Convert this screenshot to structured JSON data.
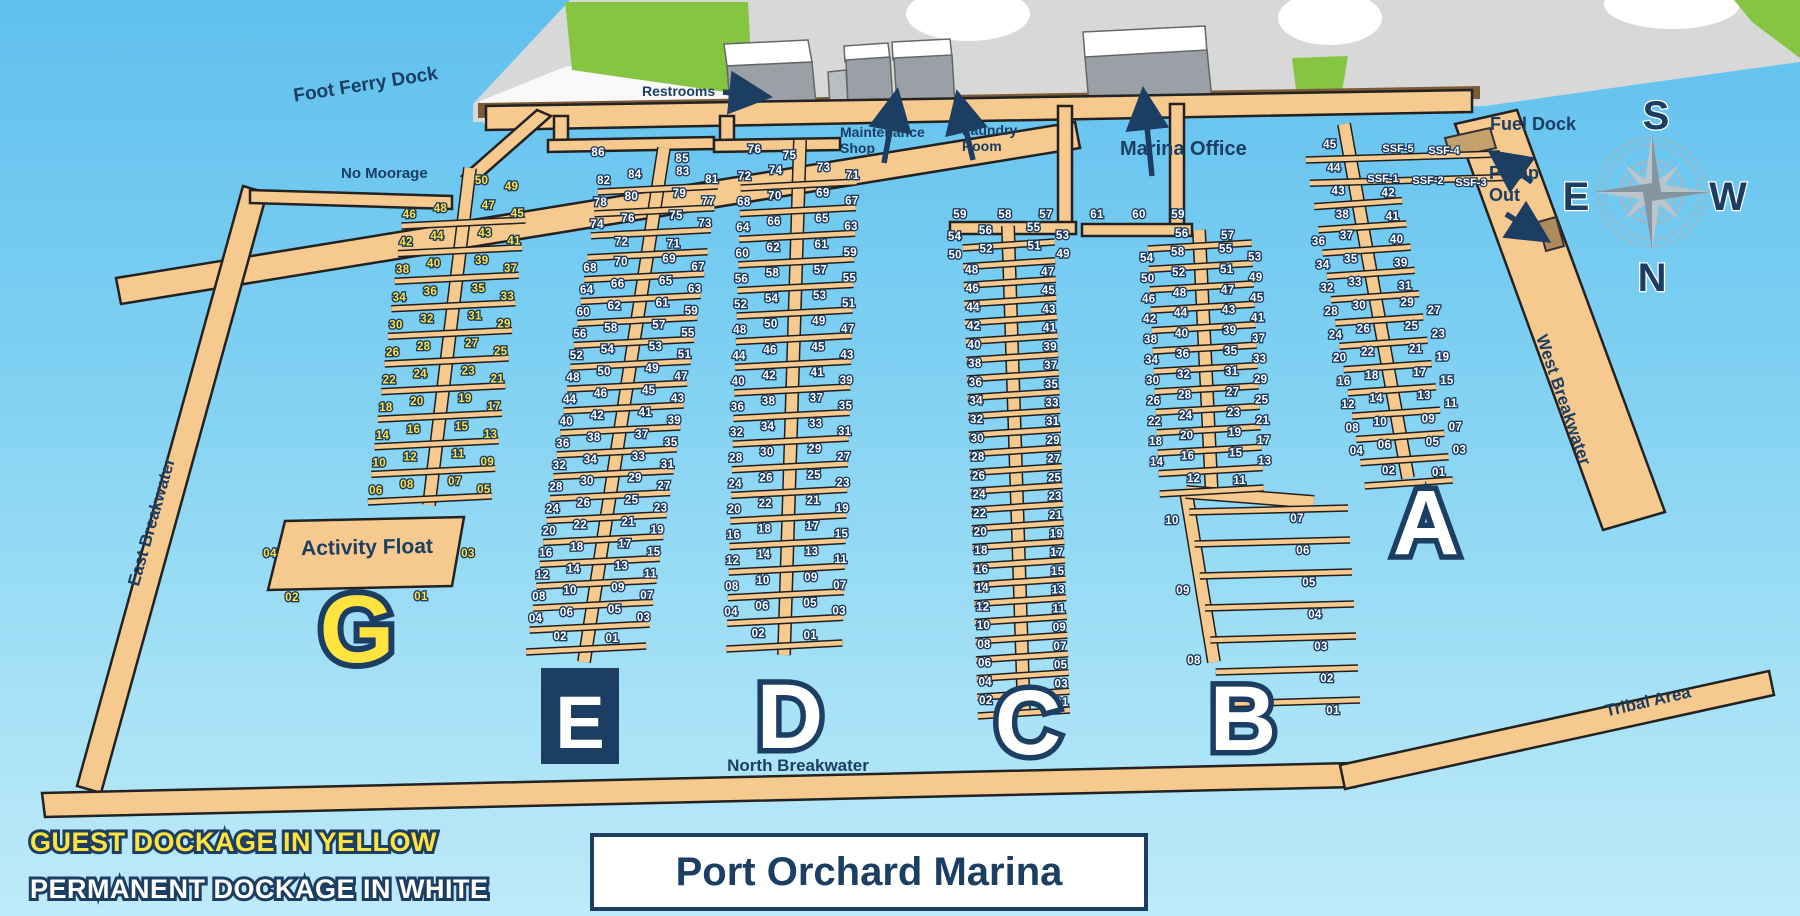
{
  "title": "Port Orchard Marina",
  "legend": {
    "guest": "GUEST DOCKAGE IN YELLOW",
    "permanent": "PERMANENT DOCKAGE IN WHITE"
  },
  "labels": {
    "foot_ferry_dock": "Foot Ferry Dock",
    "no_moorage": "No Moorage",
    "restrooms": "Restrooms",
    "maintenance_shop": "Maintenance Shop",
    "laundry_room": "Laundry Room",
    "marina_office": "Marina Office",
    "fuel_dock": "Fuel Dock",
    "pump_out": "Pump Out",
    "east_breakwater": "East Breakwater",
    "west_breakwater": "West Breakwater",
    "north_breakwater": "North Breakwater",
    "tribal_area": "Tribal Area"
  },
  "compass": {
    "top": "S",
    "bottom": "N",
    "left": "E",
    "right": "W"
  },
  "ssf_slips": [
    "SSF-5",
    "SSF-4",
    "SSF-1",
    "SSF-2",
    "SSF-3"
  ],
  "activity_float": {
    "label": "Activity Float",
    "slips": [
      "04",
      "03",
      "02",
      "01"
    ]
  },
  "docks": [
    {
      "letter": "G",
      "dockage": "guest",
      "head": [
        "50",
        "49"
      ],
      "rows": [
        [
          [
            "46",
            "48"
          ],
          [
            "47",
            "45"
          ]
        ],
        [
          [
            "42",
            "44"
          ],
          [
            "43",
            "41"
          ]
        ],
        [
          [
            "38",
            "40"
          ],
          [
            "39",
            "37"
          ]
        ],
        [
          [
            "34",
            "36"
          ],
          [
            "35",
            "33"
          ]
        ],
        [
          [
            "30",
            "32"
          ],
          [
            "31",
            "29"
          ]
        ],
        [
          [
            "26",
            "28"
          ],
          [
            "27",
            "25"
          ]
        ],
        [
          [
            "22",
            "24"
          ],
          [
            "23",
            "21"
          ]
        ],
        [
          [
            "18",
            "20"
          ],
          [
            "19",
            "17"
          ]
        ],
        [
          [
            "14",
            "16"
          ],
          [
            "15",
            "13"
          ]
        ],
        [
          [
            "10",
            "12"
          ],
          [
            "11",
            "09"
          ]
        ],
        [
          [
            "06",
            "08"
          ],
          [
            "07",
            "05"
          ]
        ]
      ]
    },
    {
      "letter": "E",
      "dockage": "permanent",
      "head": [
        "86",
        "85"
      ],
      "rows": [
        [
          [
            "82",
            "84"
          ],
          [
            "83",
            "81"
          ]
        ],
        [
          [
            "78",
            "80"
          ],
          [
            "79",
            "77"
          ]
        ],
        [
          [
            "74",
            "76"
          ],
          [
            "75",
            "73"
          ]
        ],
        [
          [
            "72"
          ],
          [
            "71"
          ]
        ],
        [
          [
            "68",
            "70"
          ],
          [
            "69",
            "67"
          ]
        ],
        [
          [
            "64",
            "66"
          ],
          [
            "65",
            "63"
          ]
        ],
        [
          [
            "60",
            "62"
          ],
          [
            "61",
            "59"
          ]
        ],
        [
          [
            "56",
            "58"
          ],
          [
            "57",
            "55"
          ]
        ],
        [
          [
            "52",
            "54"
          ],
          [
            "53",
            "51"
          ]
        ],
        [
          [
            "48",
            "50"
          ],
          [
            "49",
            "47"
          ]
        ],
        [
          [
            "44",
            "46"
          ],
          [
            "45",
            "43"
          ]
        ],
        [
          [
            "40",
            "42"
          ],
          [
            "41",
            "39"
          ]
        ],
        [
          [
            "36",
            "38"
          ],
          [
            "37",
            "35"
          ]
        ],
        [
          [
            "32",
            "34"
          ],
          [
            "33",
            "31"
          ]
        ],
        [
          [
            "28",
            "30"
          ],
          [
            "29",
            "27"
          ]
        ],
        [
          [
            "24",
            "26"
          ],
          [
            "25",
            "23"
          ]
        ],
        [
          [
            "20",
            "22"
          ],
          [
            "21",
            "19"
          ]
        ],
        [
          [
            "16",
            "18"
          ],
          [
            "17",
            "15"
          ]
        ],
        [
          [
            "12",
            "14"
          ],
          [
            "13",
            "11"
          ]
        ],
        [
          [
            "08",
            "10"
          ],
          [
            "09",
            "07"
          ]
        ],
        [
          [
            "04",
            "06"
          ],
          [
            "05",
            "03"
          ]
        ],
        [
          [
            "02"
          ],
          [
            "01"
          ]
        ]
      ]
    },
    {
      "letter": "D",
      "dockage": "permanent",
      "head": [
        "76",
        "75"
      ],
      "rows": [
        [
          [
            "72",
            "74"
          ],
          [
            "73",
            "71"
          ]
        ],
        [
          [
            "68",
            "70"
          ],
          [
            "69",
            "67"
          ]
        ],
        [
          [
            "64",
            "66"
          ],
          [
            "65",
            "63"
          ]
        ],
        [
          [
            "60",
            "62"
          ],
          [
            "61",
            "59"
          ]
        ],
        [
          [
            "56",
            "58"
          ],
          [
            "57",
            "55"
          ]
        ],
        [
          [
            "52",
            "54"
          ],
          [
            "53",
            "51"
          ]
        ],
        [
          [
            "48",
            "50"
          ],
          [
            "49",
            "47"
          ]
        ],
        [
          [
            "44",
            "46"
          ],
          [
            "45",
            "43"
          ]
        ],
        [
          [
            "40",
            "42"
          ],
          [
            "41",
            "39"
          ]
        ],
        [
          [
            "36",
            "38"
          ],
          [
            "37",
            "35"
          ]
        ],
        [
          [
            "32",
            "34"
          ],
          [
            "33",
            "31"
          ]
        ],
        [
          [
            "28",
            "30"
          ],
          [
            "29",
            "27"
          ]
        ],
        [
          [
            "24",
            "26"
          ],
          [
            "25",
            "23"
          ]
        ],
        [
          [
            "20",
            "22"
          ],
          [
            "21",
            "19"
          ]
        ],
        [
          [
            "16",
            "18"
          ],
          [
            "17",
            "15"
          ]
        ],
        [
          [
            "12",
            "14"
          ],
          [
            "13",
            "11"
          ]
        ],
        [
          [
            "08",
            "10"
          ],
          [
            "09",
            "07"
          ]
        ],
        [
          [
            "04",
            "06"
          ],
          [
            "05",
            "03"
          ]
        ],
        [
          [
            "02"
          ],
          [
            "01"
          ]
        ]
      ]
    },
    {
      "letter": "C",
      "dockage": "permanent",
      "header": [
        "59",
        "58",
        "57"
      ],
      "rows": [
        [
          [
            "54",
            "56"
          ],
          [
            "55",
            "53"
          ]
        ],
        [
          [
            "50",
            "52"
          ],
          [
            "51",
            "49"
          ]
        ],
        [
          [
            "48"
          ],
          [
            "47"
          ]
        ],
        [
          [
            "46"
          ],
          [
            "45"
          ]
        ],
        [
          [
            "44"
          ],
          [
            "43"
          ]
        ],
        [
          [
            "42"
          ],
          [
            "41"
          ]
        ],
        [
          [
            "40"
          ],
          [
            "39"
          ]
        ],
        [
          [
            "38"
          ],
          [
            "37"
          ]
        ],
        [
          [
            "36"
          ],
          [
            "35"
          ]
        ],
        [
          [
            "34"
          ],
          [
            "33"
          ]
        ],
        [
          [
            "32"
          ],
          [
            "31"
          ]
        ],
        [
          [
            "30"
          ],
          [
            "29"
          ]
        ],
        [
          [
            "28"
          ],
          [
            "27"
          ]
        ],
        [
          [
            "26"
          ],
          [
            "25"
          ]
        ],
        [
          [
            "24"
          ],
          [
            "23"
          ]
        ],
        [
          [
            "22"
          ],
          [
            "21"
          ]
        ],
        [
          [
            "20"
          ],
          [
            "19"
          ]
        ],
        [
          [
            "18"
          ],
          [
            "17"
          ]
        ],
        [
          [
            "16"
          ],
          [
            "15"
          ]
        ],
        [
          [
            "14"
          ],
          [
            "13"
          ]
        ],
        [
          [
            "12"
          ],
          [
            "11"
          ]
        ],
        [
          [
            "10"
          ],
          [
            "09"
          ]
        ],
        [
          [
            "08"
          ],
          [
            "07"
          ]
        ],
        [
          [
            "06"
          ],
          [
            "05"
          ]
        ],
        [
          [
            "04"
          ],
          [
            "03"
          ]
        ],
        [
          [
            "02"
          ],
          [
            "01"
          ]
        ]
      ]
    },
    {
      "letter": "B",
      "dockage": "permanent",
      "header": [
        "61",
        "60",
        "59"
      ],
      "rows": [
        [
          [
            "56"
          ],
          [
            "57"
          ]
        ],
        [
          [
            "54",
            "58"
          ],
          [
            "55",
            "53"
          ]
        ],
        [
          [
            "50",
            "52"
          ],
          [
            "51",
            "49"
          ]
        ],
        [
          [
            "46",
            "48"
          ],
          [
            "47",
            "45"
          ]
        ],
        [
          [
            "42",
            "44"
          ],
          [
            "43",
            "41"
          ]
        ],
        [
          [
            "38",
            "40"
          ],
          [
            "39",
            "37"
          ]
        ],
        [
          [
            "34",
            "36"
          ],
          [
            "35",
            "33"
          ]
        ],
        [
          [
            "30",
            "32"
          ],
          [
            "31",
            "29"
          ]
        ],
        [
          [
            "26",
            "28"
          ],
          [
            "27",
            "25"
          ]
        ],
        [
          [
            "22",
            "24"
          ],
          [
            "23",
            "21"
          ]
        ],
        [
          [
            "18",
            "20"
          ],
          [
            "19",
            "17"
          ]
        ],
        [
          [
            "14",
            "16"
          ],
          [
            "15",
            "13"
          ]
        ],
        [
          [
            "12"
          ],
          [
            "11"
          ]
        ]
      ],
      "lower_left": [
        "10",
        "09",
        "08"
      ],
      "lower_right": [
        "07",
        "06",
        "05",
        "04",
        "03",
        "02",
        "01"
      ]
    },
    {
      "letter": "A",
      "dockage": "permanent",
      "rows": [
        [
          [
            "45"
          ],
          []
        ],
        [
          [
            "44"
          ],
          []
        ],
        [
          [
            "43"
          ],
          [
            "42"
          ]
        ],
        [
          [
            "38"
          ],
          [
            "41"
          ]
        ],
        [
          [
            "36",
            "37"
          ],
          [
            "40"
          ]
        ],
        [
          [
            "34",
            "35"
          ],
          [
            "39"
          ]
        ],
        [
          [
            "32",
            "33"
          ],
          [
            "31"
          ]
        ],
        [
          [
            "28",
            "30"
          ],
          [
            "29",
            "27"
          ]
        ],
        [
          [
            "24",
            "26"
          ],
          [
            "25",
            "23"
          ]
        ],
        [
          [
            "20",
            "22"
          ],
          [
            "21",
            "19"
          ]
        ],
        [
          [
            "16",
            "18"
          ],
          [
            "17",
            "15"
          ]
        ],
        [
          [
            "12",
            "14"
          ],
          [
            "13",
            "11"
          ]
        ],
        [
          [
            "08",
            "10"
          ],
          [
            "09",
            "07"
          ]
        ],
        [
          [
            "04",
            "06"
          ],
          [
            "05",
            "03"
          ]
        ],
        [
          [
            "02"
          ],
          [
            "01"
          ]
        ]
      ]
    }
  ]
}
